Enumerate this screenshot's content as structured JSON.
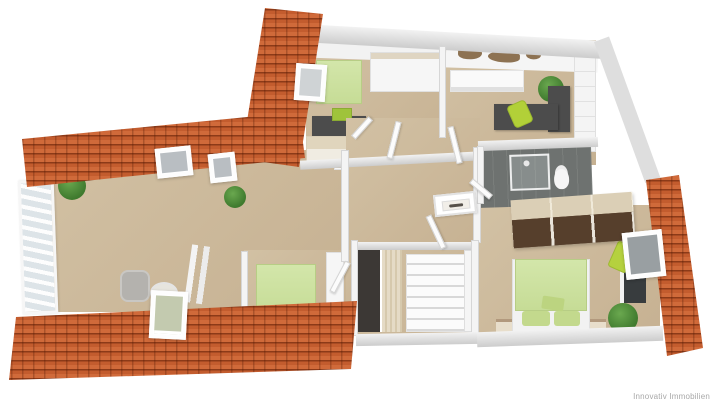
{
  "meta": {
    "type": "3d-floorplan-render",
    "view": "dollhouse-top-down",
    "floorplan_style": "attic level with cut-away roof"
  },
  "watermark": {
    "text": "Innovativ Immobilien",
    "color": "#a8a8a8"
  },
  "palette": {
    "background": "#ffffff",
    "roof_tile": "#c35c2e",
    "roof_tile_dark": "#8c3a18",
    "floor_tan": "#c9b296",
    "wall_gray": "#cccccc",
    "wall_white": "#f4f4f4",
    "bed_green": "#cde2a0",
    "accent_chair_green": "#b2d038",
    "plant_green": "#4c8a38",
    "desk_dark_gray": "#4c4c4c",
    "bathroom_floor": "#6e7270",
    "wardrobe_brown": "#563f2c",
    "wood_light": "#ddd1b8"
  },
  "scene": {
    "roof_sections": [
      "top-left-vertical",
      "top-left-horizontal",
      "bottom-left-strip",
      "right-strip"
    ],
    "skylight_count": 5,
    "rooms": [
      {
        "name": "living-room",
        "position": "left",
        "features": [
          "window-wall-left",
          "plants",
          "gray-armchair",
          "round-glass-table",
          "white-easel",
          "radiator",
          "roof-skylights"
        ]
      },
      {
        "name": "bedroom-top",
        "position": "top-center",
        "features": [
          "green-single-bed",
          "white-wardrobe",
          "dark-desk",
          "green-box",
          "wood-dresser"
        ]
      },
      {
        "name": "office",
        "position": "top-right",
        "features": [
          "world-map-wall-decal",
          "white-sideboard",
          "dark-l-desk",
          "green-office-chair",
          "plant",
          "white-closet"
        ]
      },
      {
        "name": "bathroom",
        "position": "middle-right",
        "features": [
          "dark-tile-floor",
          "glass-shower",
          "toilet"
        ]
      },
      {
        "name": "hallway",
        "position": "center",
        "features": [
          "open-white-doors",
          "framed-picture",
          "built-in-wardrobe-brown"
        ]
      },
      {
        "name": "staircase",
        "position": "bottom-center",
        "features": [
          "white-stairs",
          "dark-wardrobe",
          "wood-panel",
          "railing"
        ]
      },
      {
        "name": "bedroom-right",
        "position": "bottom-right",
        "features": [
          "green-double-bed",
          "pillows",
          "nightstands",
          "wall-tv",
          "green-lounge-chair",
          "plant",
          "open-roof-window"
        ]
      },
      {
        "name": "bedroom-bottom-center",
        "position": "bottom-center-left",
        "features": [
          "green-single-bed",
          "white-cabinet"
        ]
      }
    ]
  }
}
